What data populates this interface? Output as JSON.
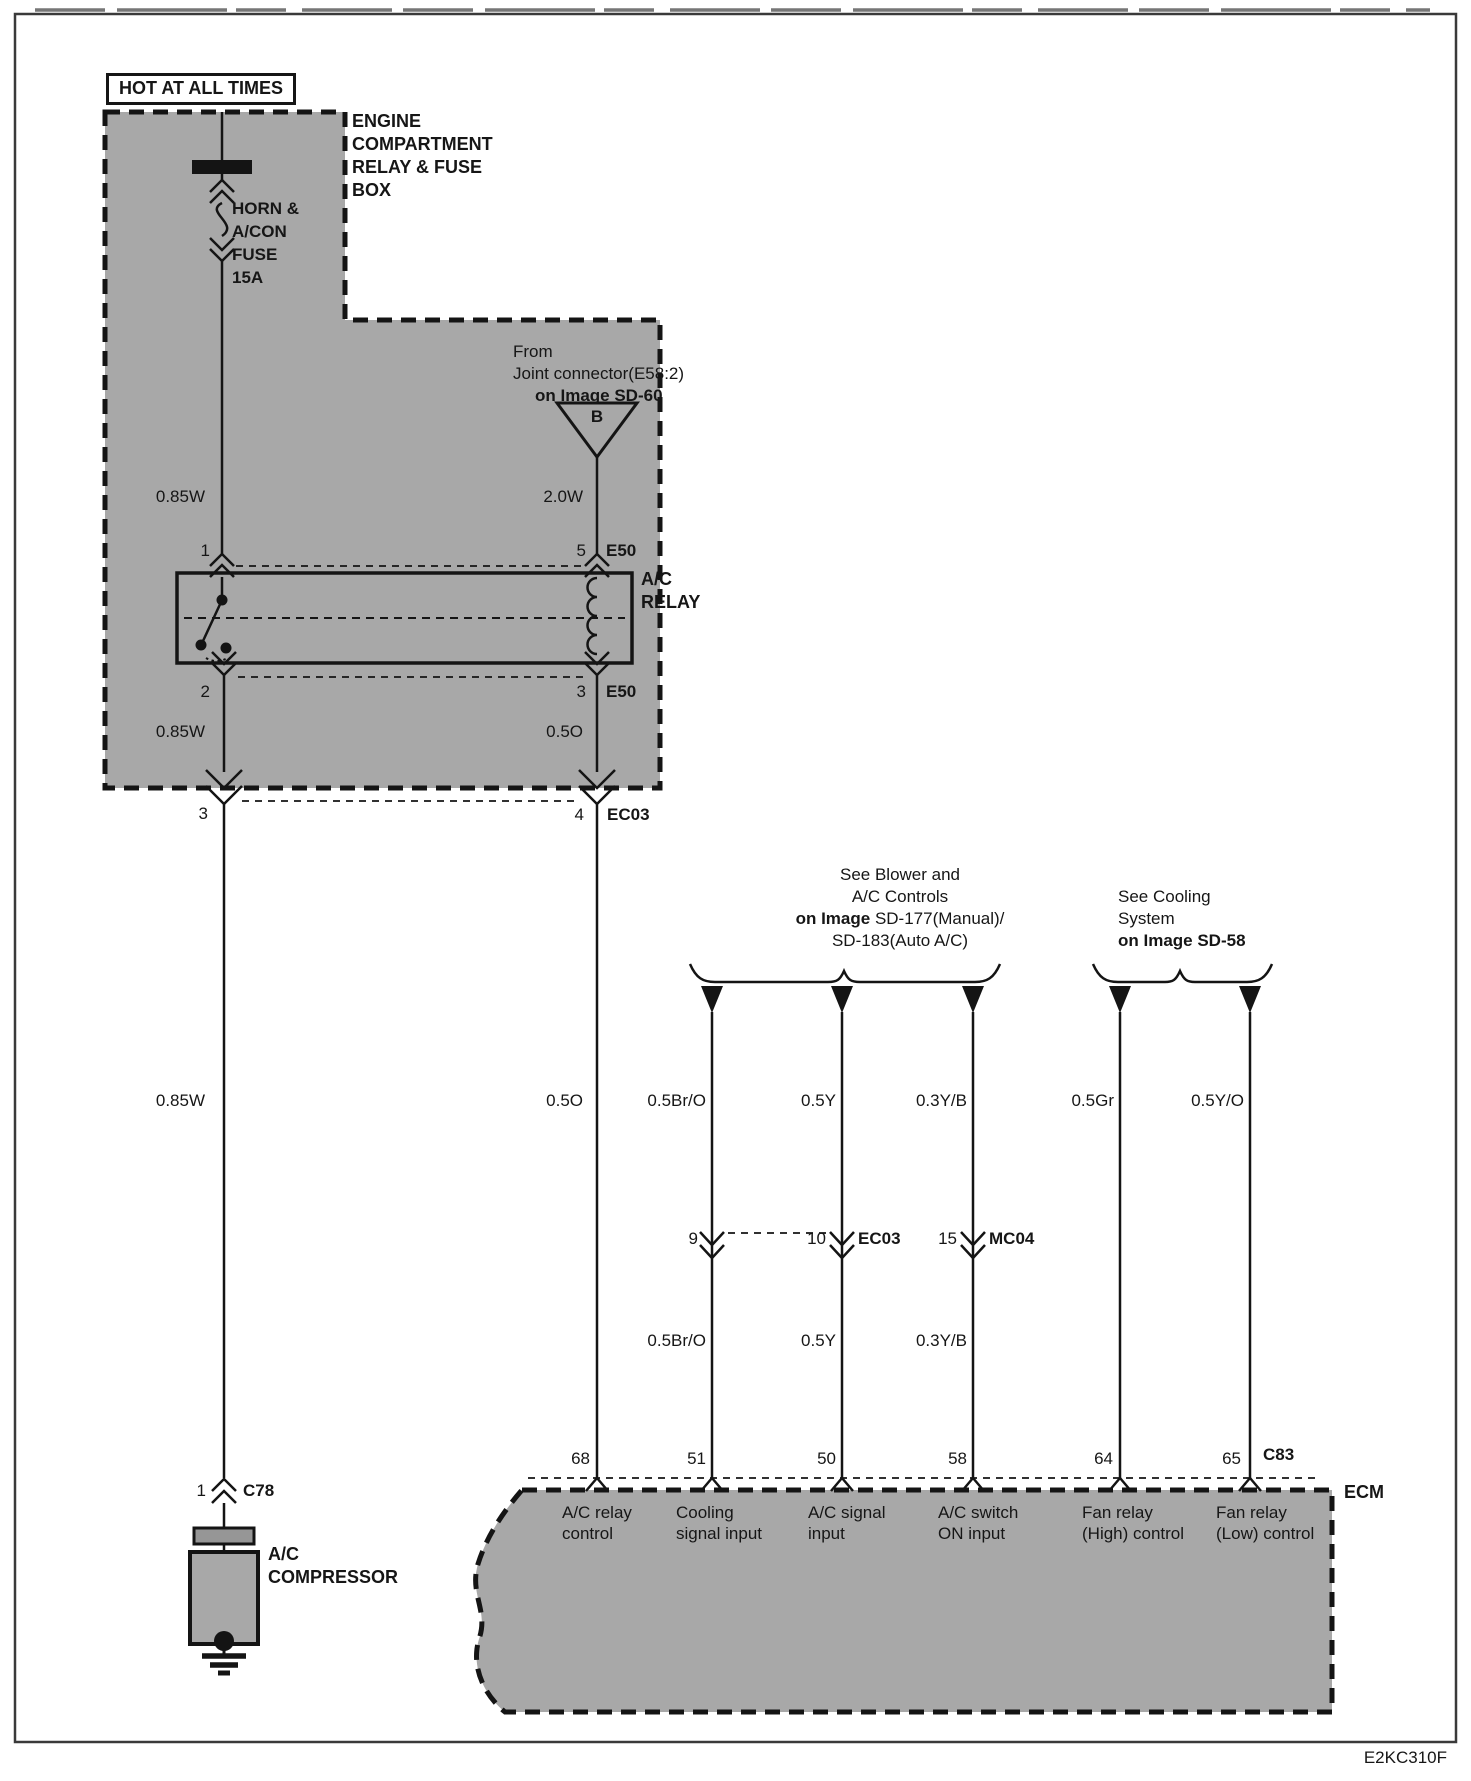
{
  "page": {
    "footer_code": "E2KC310F"
  },
  "power": {
    "hot_label": "HOT AT ALL TIMES"
  },
  "fuse_box": {
    "name_lines": [
      "ENGINE",
      "COMPARTMENT",
      "RELAY & FUSE",
      "BOX"
    ],
    "fuse_lines": [
      "HORN &",
      "A/CON",
      "FUSE",
      "15A"
    ],
    "wire_top": "0.85W"
  },
  "joint": {
    "line1": "From",
    "line2": "Joint connector(E58:2)",
    "line3": "on Image SD-60",
    "tag": "B",
    "wire": "2.0W"
  },
  "relay": {
    "name_line1": "A/C",
    "name_line2": "RELAY",
    "pin_in_left": "1",
    "pin_in_right": "5",
    "conn_in": "E50",
    "pin_out_left": "2",
    "pin_out_right": "3",
    "conn_out": "E50",
    "wire_out_left": "0.85W",
    "wire_out_right": "0.5O"
  },
  "box_exit": {
    "pin_left": "3",
    "pin_right": "4",
    "conn": "EC03"
  },
  "runs": {
    "compressor_wire": "0.85W",
    "relay_wire": "0.5O",
    "cooling_wire": "0.5Br/O",
    "ac_signal_wire": "0.5Y",
    "ac_switch_wire": "0.3Y/B",
    "fan_high_wire": "0.5Gr",
    "fan_low_wire": "0.5Y/O",
    "cooling_wire2": "0.5Br/O",
    "ac_signal_wire2": "0.5Y",
    "ac_switch_wire2": "0.3Y/B"
  },
  "mid_conn": {
    "pin9": "9",
    "pin10": "10",
    "conn10": "EC03",
    "pin15": "15",
    "conn15": "MC04"
  },
  "blower_note": {
    "line1": "See Blower and",
    "line2": "A/C Controls",
    "line3_bold": "on Image",
    "line3_rest": " SD-177(Manual)/",
    "line4": "SD-183(Auto A/C)"
  },
  "cooling_note": {
    "line1": "See Cooling",
    "line2": "System",
    "line3": "on Image SD-58"
  },
  "ecm": {
    "label": "ECM",
    "conn": "C83",
    "pins": [
      {
        "num": "68",
        "fn1": "A/C relay",
        "fn2": "control"
      },
      {
        "num": "51",
        "fn1": "Cooling",
        "fn2": "signal input"
      },
      {
        "num": "50",
        "fn1": "A/C signal",
        "fn2": "input"
      },
      {
        "num": "58",
        "fn1": "A/C switch",
        "fn2": "ON input"
      },
      {
        "num": "64",
        "fn1": "Fan relay",
        "fn2": "(High) control"
      },
      {
        "num": "65",
        "fn1": "Fan relay",
        "fn2": "(Low) control"
      }
    ]
  },
  "compressor": {
    "pin": "1",
    "conn": "C78",
    "name_line1": "A/C",
    "name_line2": "COMPRESSOR"
  },
  "colors": {
    "line": "#161616",
    "box_gray": "#a8a8a8",
    "bg": "#ffffff"
  }
}
